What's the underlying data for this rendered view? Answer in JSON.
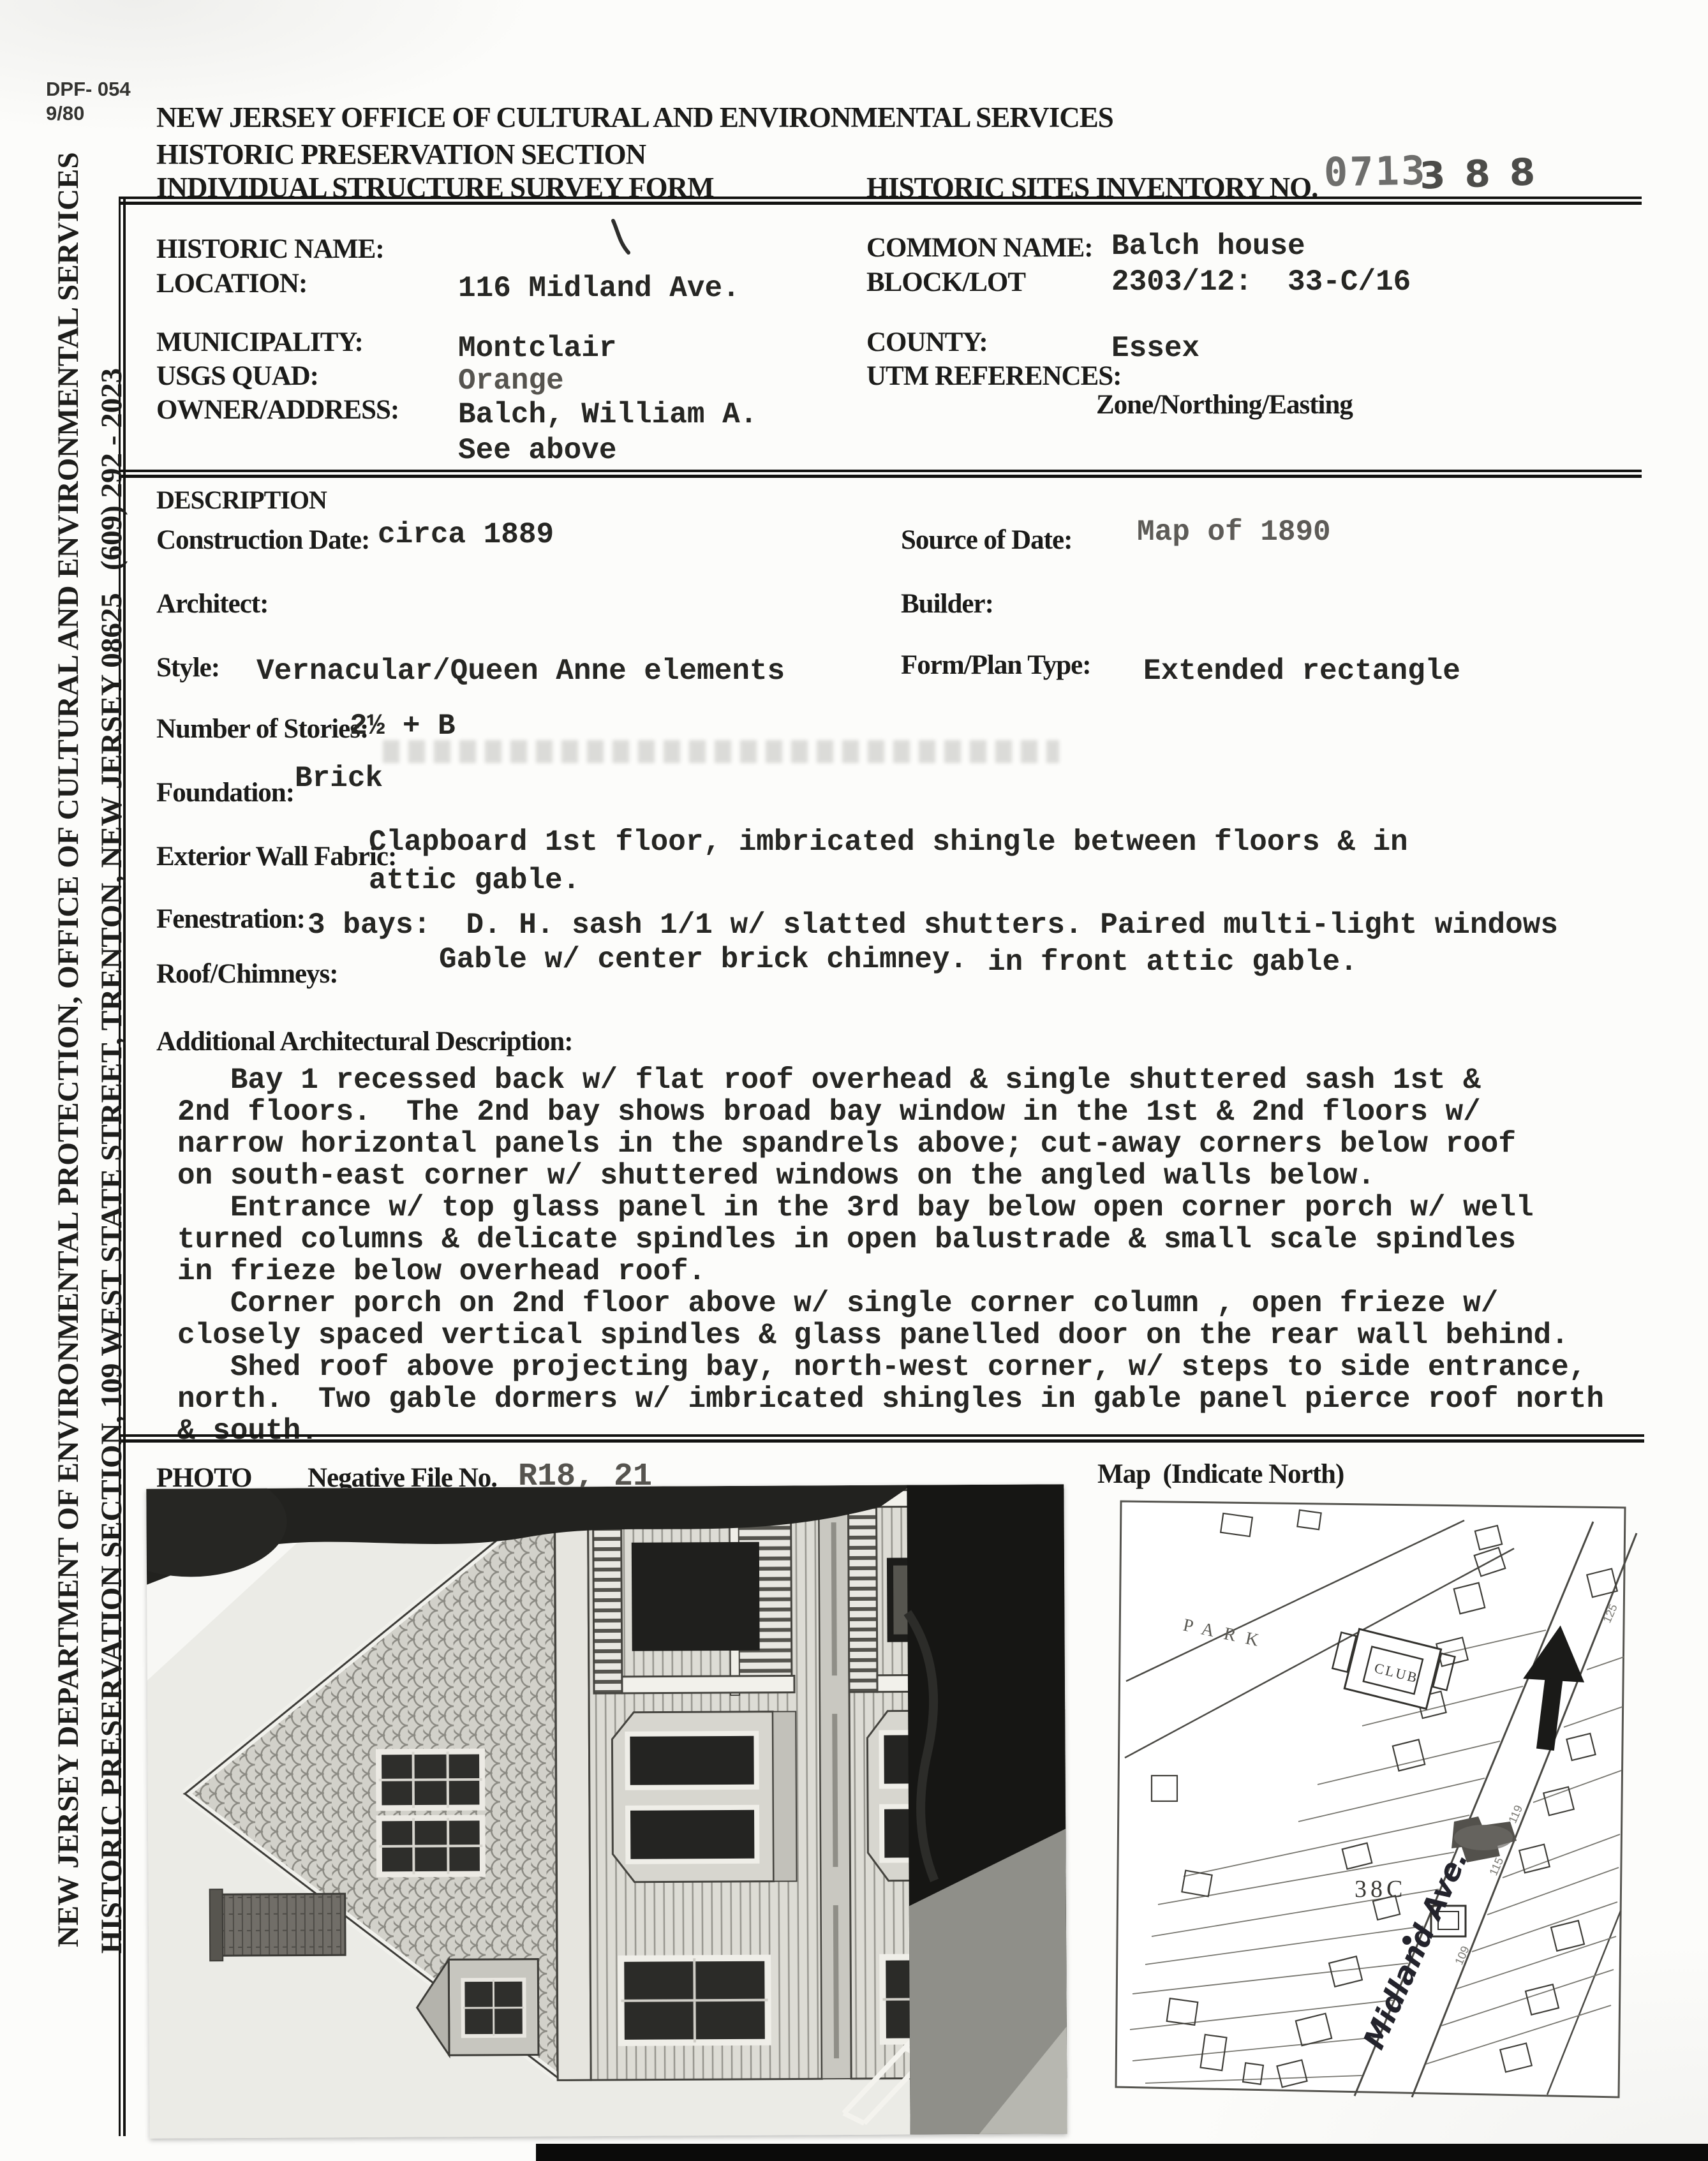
{
  "form_meta": {
    "form_number": "DPF- 054",
    "form_date": "9/80"
  },
  "header": {
    "agency": "NEW JERSEY OFFICE OF CULTURAL AND ENVIRONMENTAL SERVICES",
    "section": "HISTORIC PRESERVATION SECTION",
    "form_title": "INDIVIDUAL STRUCTURE SURVEY FORM",
    "inventory_label": "HISTORIC SITES INVENTORY NO.",
    "inventory_stamp": "0713",
    "inventory_handwritten": "388"
  },
  "identification": {
    "historic_name_label": "HISTORIC NAME:",
    "location_label": "LOCATION:",
    "location_value": "116 Midland Ave.",
    "common_name_label": "COMMON NAME:",
    "common_name_value": "Balch house",
    "block_lot_label": "BLOCK/LOT",
    "block_lot_value": "2303/12:  33-C/16",
    "municipality_label": "MUNICIPALITY:",
    "municipality_value": "Montclair",
    "usgs_quad_label": "USGS QUAD:",
    "usgs_quad_value": "Orange",
    "owner_label": "OWNER/ADDRESS:",
    "owner_value": "Balch, William A.",
    "owner_value2": "See above",
    "county_label": "COUNTY:",
    "county_value": "Essex",
    "utm_label": "UTM REFERENCES:",
    "utm_sublabel": "Zone/Northing/Easting"
  },
  "description": {
    "heading": "DESCRIPTION",
    "construction_date_label": "Construction Date:",
    "construction_date_value": "circa 1889",
    "source_of_date_label": "Source of Date:",
    "source_of_date_value": "Map of 1890",
    "architect_label": "Architect:",
    "builder_label": "Builder:",
    "style_label": "Style:",
    "style_value": "Vernacular/Queen Anne elements",
    "form_plan_label": "Form/Plan Type:",
    "form_plan_value": "Extended rectangle",
    "stories_label": "Number of Stories:",
    "stories_value": "2½ + B",
    "foundation_label": "Foundation:",
    "foundation_value": "Brick",
    "wall_fabric_label": "Exterior Wall Fabric:",
    "wall_fabric_value1": "Clapboard 1st floor, imbricated shingle between floors & in",
    "wall_fabric_value2": "attic gable.",
    "fenestration_label": "Fenestration:",
    "fenestration_value1": "3 bays:  D. H. sash 1/1 w/ slatted shutters. Paired multi-light windows",
    "fenestration_value2": "in front attic gable.",
    "roof_label": "Roof/Chimneys:",
    "roof_value": "Gable w/ center brick chimney."
  },
  "additional": {
    "heading": "Additional Architectural Description:",
    "lines": [
      "   Bay 1 recessed back w/ flat roof overhead & single shuttered sash 1st &",
      "2nd floors.  The 2nd bay shows broad bay window in the 1st & 2nd floors w/",
      "narrow horizontal panels in the spandrels above; cut-away corners below roof",
      "on south-east corner w/ shuttered windows on the angled walls below.",
      "   Entrance w/ top glass panel in the 3rd bay below open corner porch w/ well",
      "turned columns & delicate spindles in open balustrade & small scale spindles",
      "in frieze below overhead roof.",
      "   Corner porch on 2nd floor above w/ single corner column , open frieze w/",
      "closely spaced vertical spindles & glass panelled door on the rear wall behind.",
      "   Shed roof above projecting bay, north-west corner, w/ steps to side entrance,",
      "north.  Two gable dormers w/ imbricated shingles in gable panel pierce roof north",
      "& south."
    ]
  },
  "photo_section": {
    "photo_label": "PHOTO",
    "negative_label": "Negative File No.",
    "negative_value": "R18, 21",
    "map_label": "Map  (Indicate North)"
  },
  "map": {
    "park_label": "PARK",
    "club_label": "CLUB",
    "block_label": "38C",
    "street_label": "Midland Ave.",
    "lot_numbers": [
      "119",
      "115",
      "109",
      "125"
    ]
  },
  "sidebar": {
    "line1": "NEW JERSEY DEPARTMENT OF ENVIRONMENTAL PROTECTION, OFFICE OF CULTURAL AND ENVIRONMENTAL SERVICES",
    "line2": "HISTORIC PRESERVATION SECTION, 109 WEST STATE STREET, TRENTON, NEW JERSEY 08625   (609) 292 - 2023"
  },
  "colors": {
    "ink": "#1c1c1a",
    "typewriter": "#262623",
    "stamp_gray": "#6e6e6c",
    "paper": "#fcfcfa"
  }
}
